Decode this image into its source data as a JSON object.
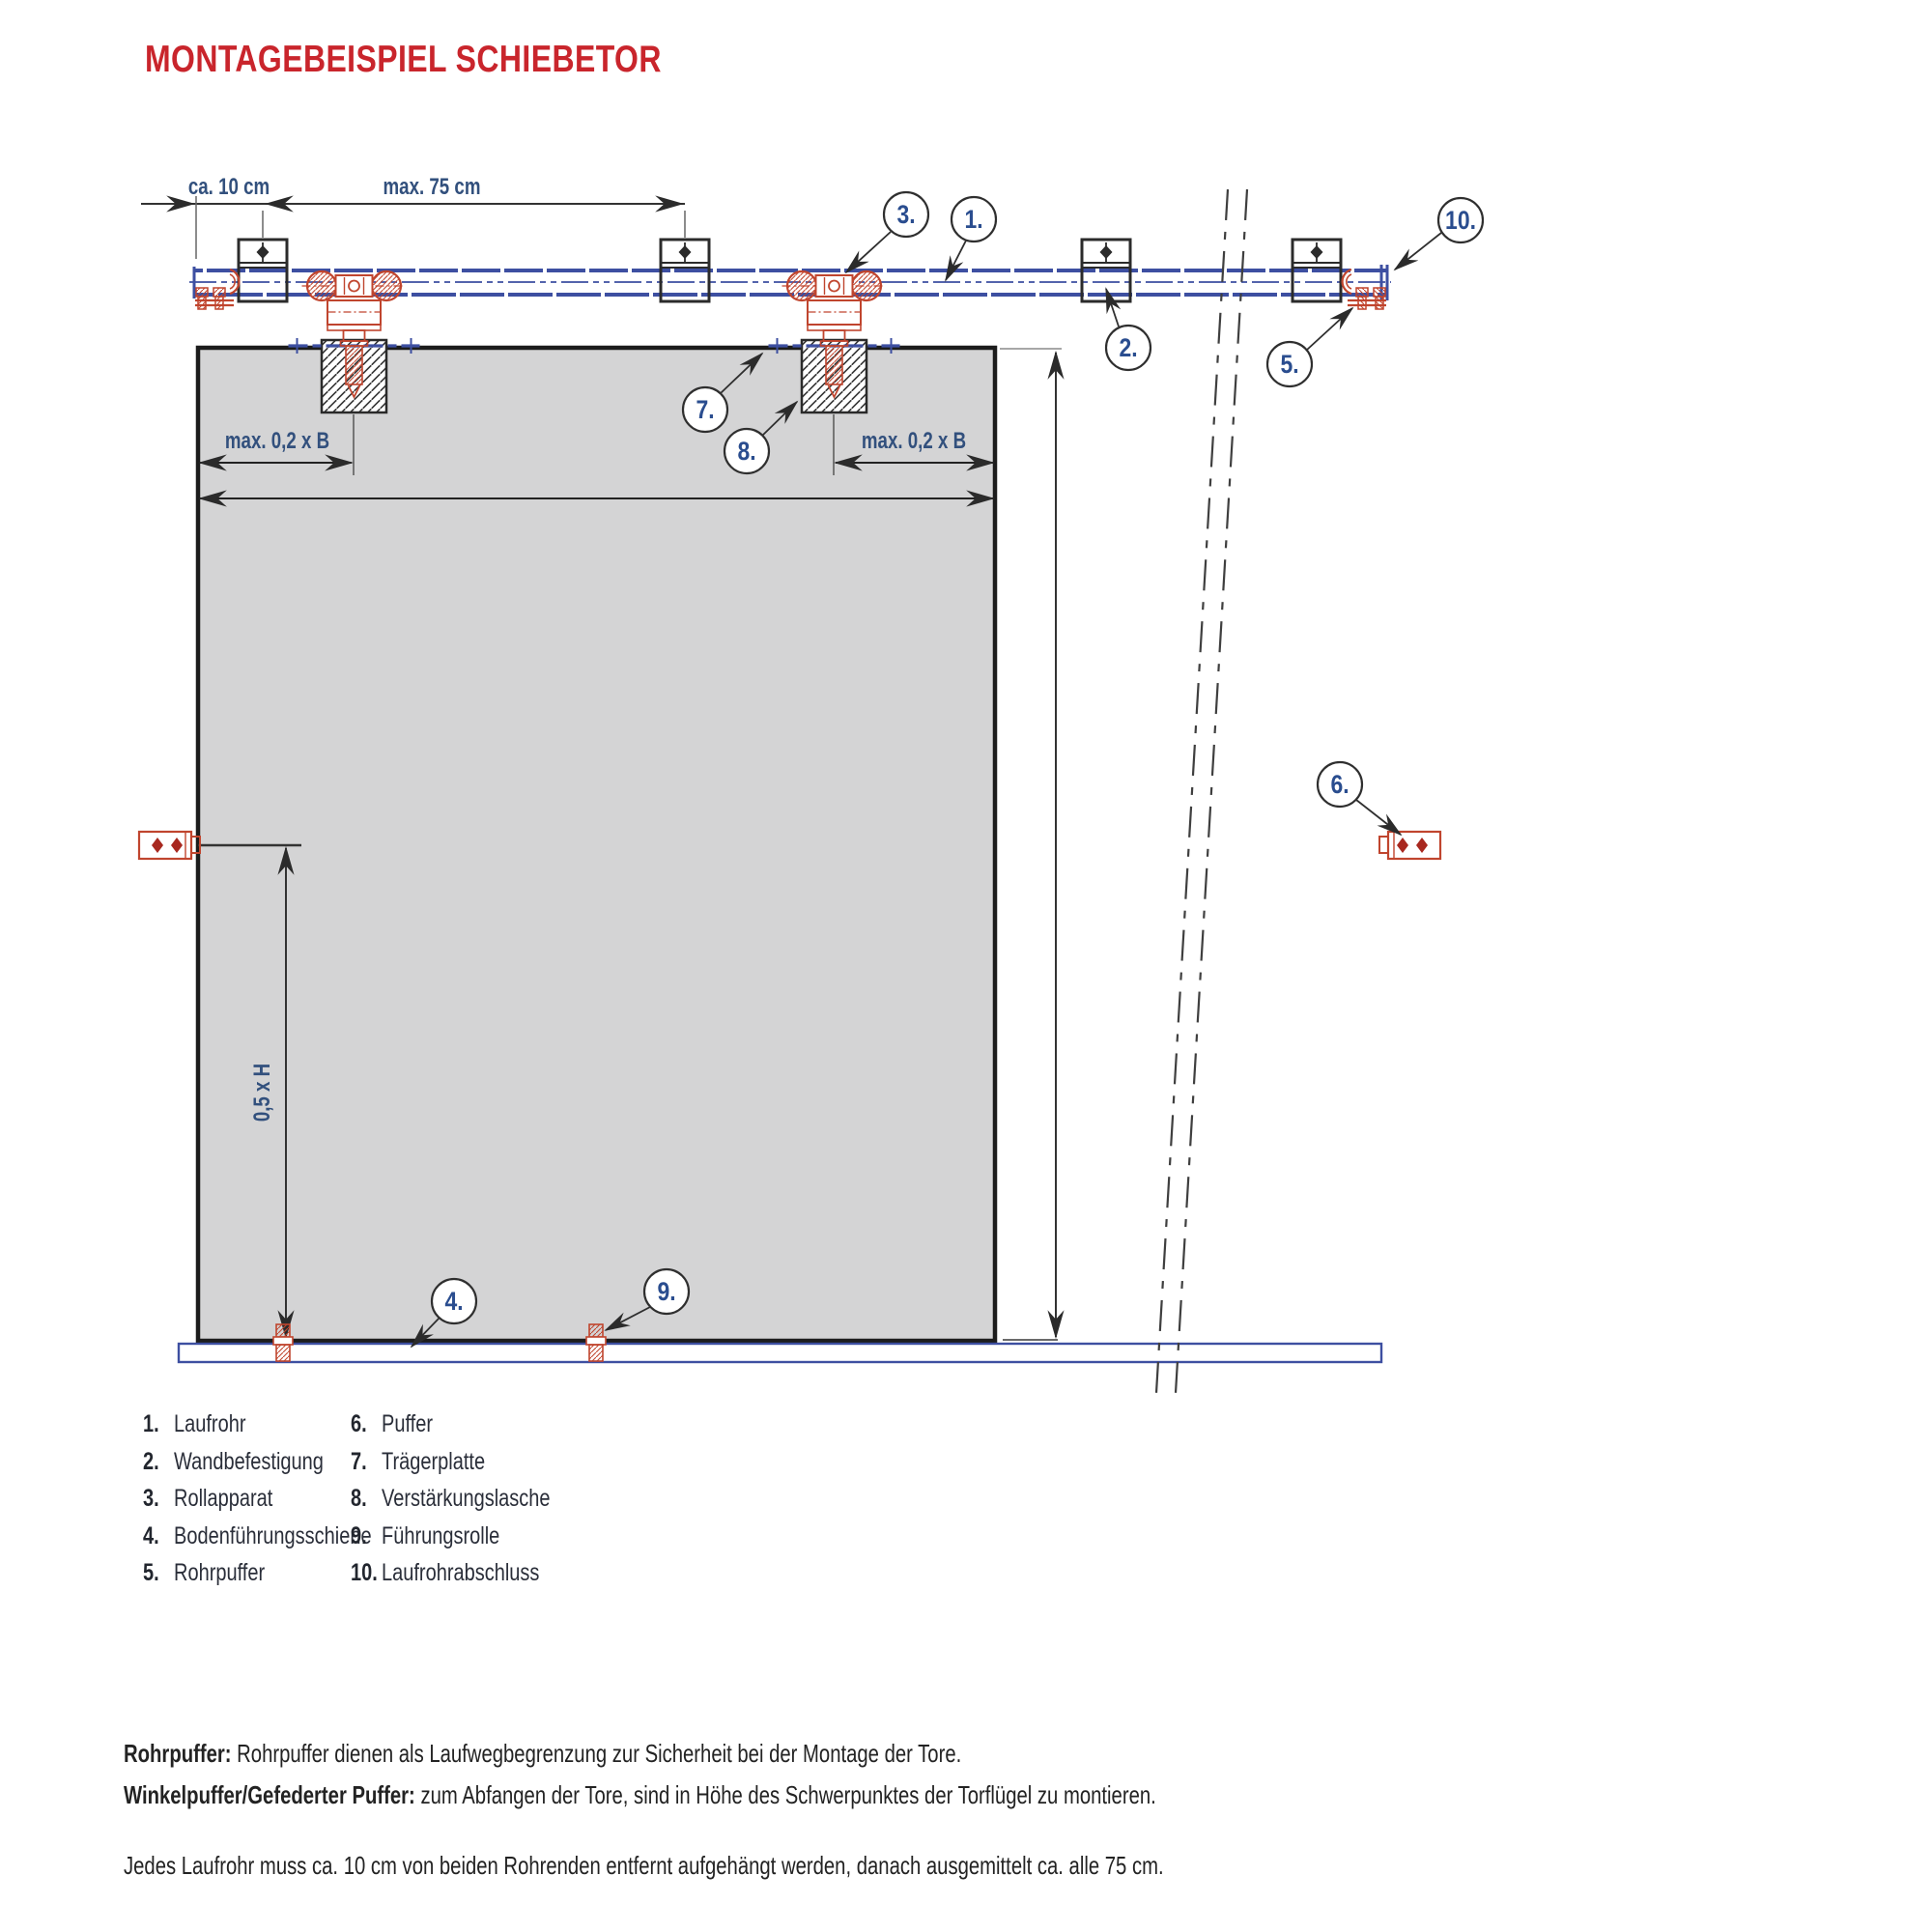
{
  "title": "MONTAGEBEISPIEL SCHIEBETOR",
  "colors": {
    "title_red": "#c9252c",
    "hardware_red": "#c0452e",
    "rail_blue": "#3d4fa1",
    "label_blue": "#32507d",
    "callout_blue": "#2a4d8f",
    "gate_gray": "#d4d4d5",
    "line_black": "#2b2b2b"
  },
  "labels": {
    "dim_end_offset": "ca. 10 cm",
    "dim_spacing": "max. 75 cm",
    "dim_02b_left": "max. 0,2 x B",
    "dim_02b_right": "max. 0,2 x B",
    "dim_half_height": "0,5 x H"
  },
  "callouts": [
    {
      "label": "1."
    },
    {
      "label": "2."
    },
    {
      "label": "3."
    },
    {
      "label": "4."
    },
    {
      "label": "5."
    },
    {
      "label": "6."
    },
    {
      "label": "7."
    },
    {
      "label": "8."
    },
    {
      "label": "9."
    },
    {
      "label": "10."
    }
  ],
  "legend": {
    "items": [
      {
        "num": "1.",
        "label": "Laufrohr"
      },
      {
        "num": "2.",
        "label": "Wandbefestigung"
      },
      {
        "num": "3.",
        "label": "Rollapparat"
      },
      {
        "num": "4.",
        "label": "Bodenführungsschiene"
      },
      {
        "num": "5.",
        "label": "Rohrpuffer"
      },
      {
        "num": "6.",
        "label": "Puffer"
      },
      {
        "num": "7.",
        "label": "Trägerplatte"
      },
      {
        "num": "8.",
        "label": "Verstärkungslasche"
      },
      {
        "num": "9.",
        "label": "Führungsrolle"
      },
      {
        "num": "10.",
        "label": "Laufrohrabschluss"
      }
    ]
  },
  "notes": [
    {
      "lead": "Rohrpuffer:",
      "text": " Rohrpuffer dienen als Laufwegbegrenzung zur Sicherheit bei der Montage der Tore."
    },
    {
      "lead": "Winkelpuffer/Gefederter Puffer:",
      "text": " zum Abfangen der Tore, sind in Höhe des Schwerpunktes der Torflügel zu montieren."
    }
  ],
  "footnote": "Jedes Laufrohr muss ca. 10 cm von beiden Rohrenden entfernt aufgehängt werden, danach ausgemittelt ca. alle 75 cm."
}
